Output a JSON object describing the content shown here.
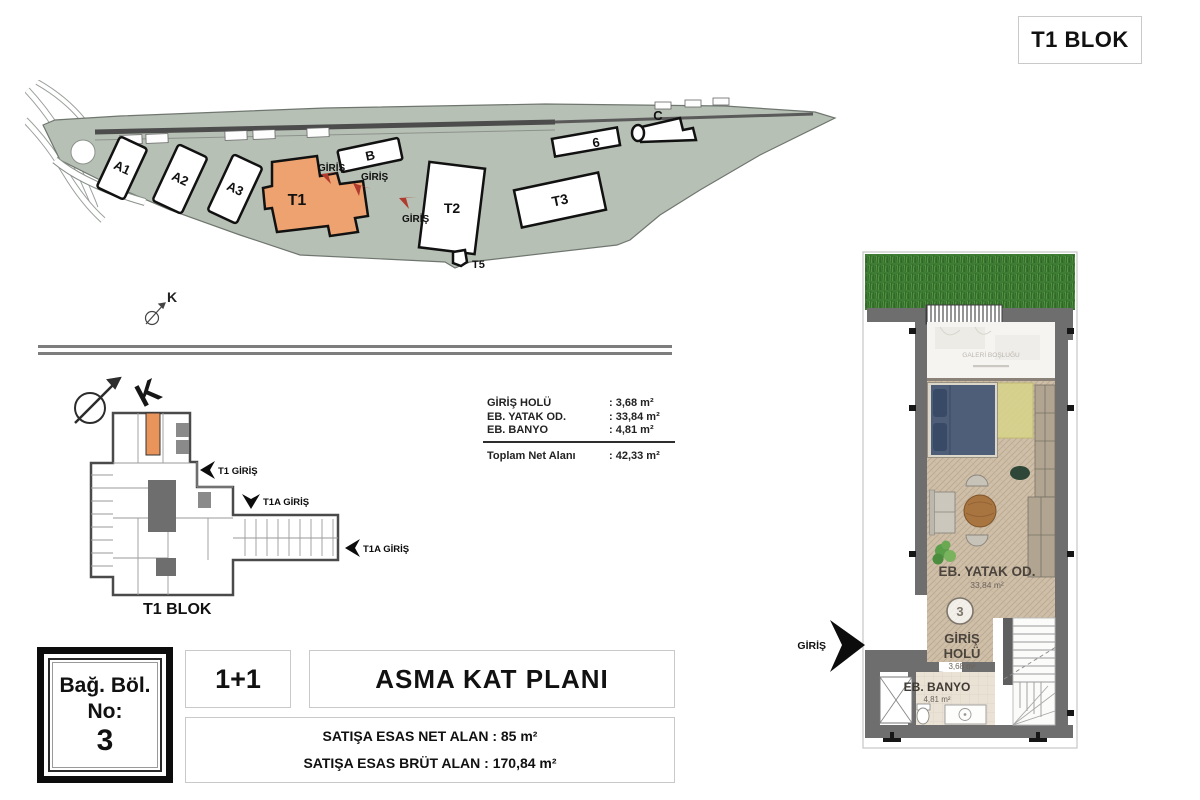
{
  "title_box": {
    "label": "T1 BLOK"
  },
  "site_plan": {
    "north_label": "K",
    "buildings": {
      "a1": "A1",
      "a2": "A2",
      "a3": "A3",
      "b": "B",
      "t1": "T1",
      "t2": "T2",
      "t3": "T3",
      "t5": "T5",
      "c": "C",
      "b6": "6"
    },
    "entrances": [
      "GİRİŞ",
      "GİRİŞ",
      "GİRİŞ"
    ],
    "colors": {
      "land": "#b7c0b5",
      "highlight": "#eea26f",
      "arrow_red": "#b03a2e"
    }
  },
  "key_plan": {
    "north_label": "K",
    "entrances": {
      "t1": "T1 GİRİŞ",
      "t1a_1": "T1A GİRİŞ",
      "t1a_2": "T1A GİRİŞ"
    },
    "block_label": "T1 BLOK"
  },
  "area_table": {
    "rows": [
      {
        "name": "GİRİŞ HOLÜ",
        "value": ": 3,68 m²"
      },
      {
        "name": "EB. YATAK OD.",
        "value": ": 33,84 m²"
      },
      {
        "name": "EB. BANYO",
        "value": ": 4,81 m²"
      }
    ],
    "total": {
      "name": "Toplam Net Alanı",
      "value": ": 42,33 m²"
    }
  },
  "unit_badge": {
    "line1": "Bağ. Böl.",
    "line2": "No:",
    "number": "3"
  },
  "plan_type": {
    "label": "1+1"
  },
  "plan_title": {
    "label": "ASMA KAT PLANI"
  },
  "sales_area": {
    "net": "SATIŞA ESAS NET ALAN : 85 m²",
    "brut": "SATIŞA ESAS BRÜT ALAN : 170,84 m²"
  },
  "detail_plan": {
    "unit_number": "3",
    "entrance_label": "GİRİŞ",
    "rooms": {
      "gallery": {
        "name": "GALERİ BOŞLUĞU"
      },
      "bedroom": {
        "name": "EB. YATAK OD.",
        "area": "33,84 m²"
      },
      "hall": {
        "name_line1": "GİRİŞ",
        "name_line2": "HOLÜ",
        "area": "3,68 m²"
      },
      "bath": {
        "name": "EB. BANYO",
        "area": "4,81 m²"
      }
    }
  }
}
